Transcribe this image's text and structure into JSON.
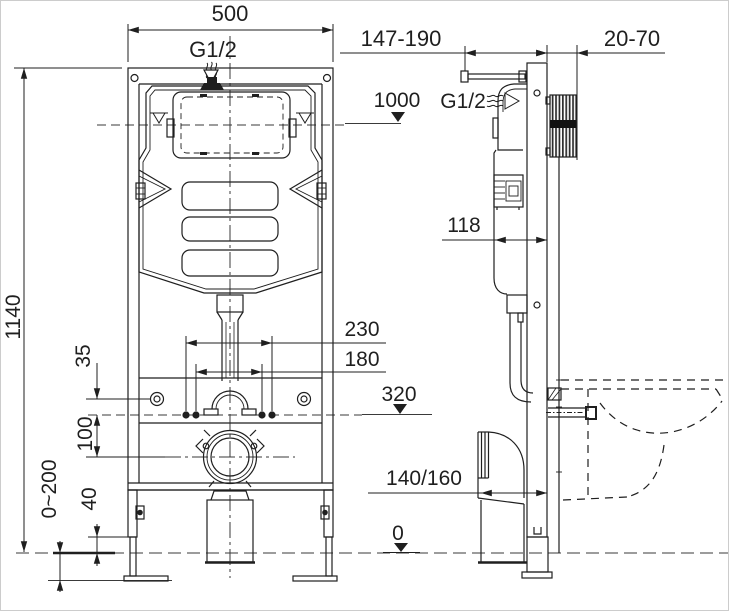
{
  "dimensions": {
    "frame_width": "500",
    "inlet_top": "G1/2",
    "bracket_range": "147-190",
    "wall_clearance": "20-70",
    "inlet_height": "1000",
    "inlet_side": "G1/2",
    "frame_height": "1140",
    "cistern_depth": "118",
    "fixing_span_outer": "230",
    "fixing_span_inner": "180",
    "plate_offset": "35",
    "outlet_drop": "100",
    "frame_foot_gap": "40",
    "leg_adjust_range": "0~200",
    "fixing_height": "320",
    "drain_offset": "140/160",
    "floor_level": "0"
  },
  "colors": {
    "line": "#1f1f1f",
    "background": "#ffffff"
  }
}
